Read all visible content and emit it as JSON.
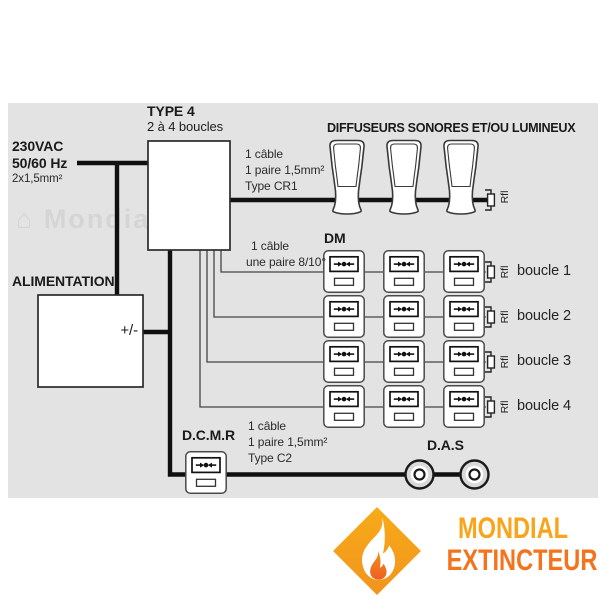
{
  "panel": {
    "background": "#e3e3e3",
    "line_color": "#101010",
    "watermark": "Mondial"
  },
  "power": {
    "line1": "230VAC",
    "line2": "50/60 Hz",
    "line3": "2x1,5mm²"
  },
  "central_unit": {
    "title": "TYPE 4",
    "subtitle": "2 à 4 boucles"
  },
  "alimentation": {
    "label": "ALIMENTATION",
    "terminal": "+/-"
  },
  "diffuseurs": {
    "header": "DIFFUSEURS SONORES ET/OU LUMINEUX",
    "cable": [
      "1 câble",
      "1 paire 1,5mm²",
      "Type CR1"
    ]
  },
  "dm": {
    "label": "DM",
    "cable": [
      "1 câble",
      "une paire 8/10°"
    ],
    "boucles": [
      "boucle 1",
      "boucle 2",
      "boucle 3",
      "boucle 4"
    ],
    "resistor_label": "Rfl"
  },
  "dcmr": {
    "label": "D.C.M.R",
    "cable": [
      "1 câble",
      "1 paire 1,5mm²",
      "Type C2"
    ]
  },
  "das": {
    "label": "D.A.S"
  },
  "logo": {
    "line1": "MONDIAL",
    "line2": "EXTINCTEUR",
    "yellow": "#f9a51b",
    "orange": "#f4731c"
  }
}
